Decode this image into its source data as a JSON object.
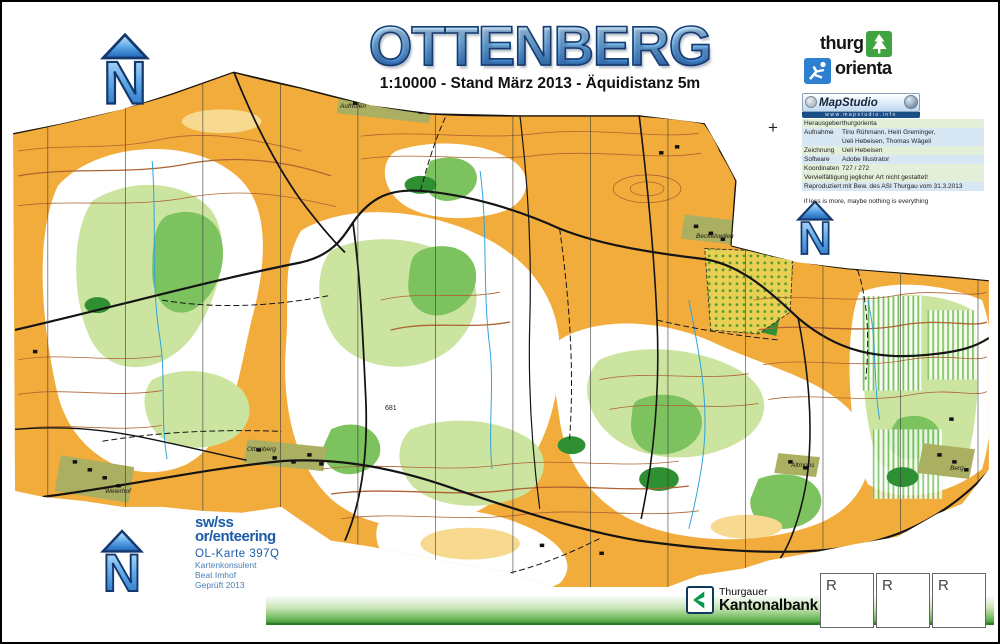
{
  "title": {
    "text": "OTTENBERG",
    "subtitle": "1:10000 - Stand März 2013 - Äquidistanz 5m"
  },
  "north": {
    "letter": "N"
  },
  "registration_mark": "+",
  "logos": {
    "thurgorienta": {
      "word1": "thurg",
      "word2": "orienta"
    },
    "mapstudio": {
      "name": "MapStudio",
      "url": "www.mapstudio.info"
    },
    "swiss": {
      "line1": "sw/ss",
      "line2": "or/enteering",
      "map_ref": "OL-Karte 397Q",
      "details": [
        "Kartenkonsulent",
        "Beat Imhof",
        "Geprüft 2013"
      ]
    },
    "bank": {
      "line1": "Thurgauer",
      "line2": "Kantonalbank"
    }
  },
  "info_table": {
    "rows": [
      {
        "label": "Herausgeber",
        "value": "thurgorienta",
        "cls": "g"
      },
      {
        "label": "Aufnahme",
        "value": "Tino Rühmann, Heiri Greminger,",
        "cls": "b"
      },
      {
        "label": "",
        "value": "Ueli Hebeisen, Thomas Wägeli",
        "cls": "b"
      },
      {
        "label": "Zeichnung",
        "value": "Ueli Hebeisen",
        "cls": "g"
      },
      {
        "label": "Software",
        "value": "Adobe Illustrator",
        "cls": "b"
      },
      {
        "label": "Koordinaten",
        "value": "727 / 272",
        "cls": "g"
      }
    ],
    "notes": [
      {
        "text": "Vervielfältigung jeglicher Art nicht gestattet!",
        "cls": "g"
      },
      {
        "text": "Reproduziert mit Bew. des ASI Thurgau vom 31.3.2013",
        "cls": "b"
      }
    ],
    "motto": "if less is more, maybe nothing is everything"
  },
  "stamp_boxes": [
    "R",
    "R",
    "R"
  ],
  "map": {
    "labels": [
      {
        "text": "Aufhofen",
        "x": 338,
        "y": 101
      },
      {
        "text": "Beckelswilen",
        "x": 694,
        "y": 231
      },
      {
        "text": "Ottenberg",
        "x": 245,
        "y": 444
      },
      {
        "text": "Weierhof",
        "x": 103,
        "y": 486
      },
      {
        "text": "Altmoos",
        "x": 789,
        "y": 460
      },
      {
        "text": "Berg",
        "x": 948,
        "y": 463
      }
    ],
    "spot_height": {
      "text": "681",
      "x": 383,
      "y": 403
    },
    "colors": {
      "open_land": "#F2AC3C",
      "forest": "#FFFFFF",
      "veg_light": "#CBE49F",
      "veg_mid": "#7CC25F",
      "veg_dark": "#2F8F33",
      "contour": "#AE6332",
      "water": "#2FA3DC",
      "road": "#141414"
    }
  }
}
